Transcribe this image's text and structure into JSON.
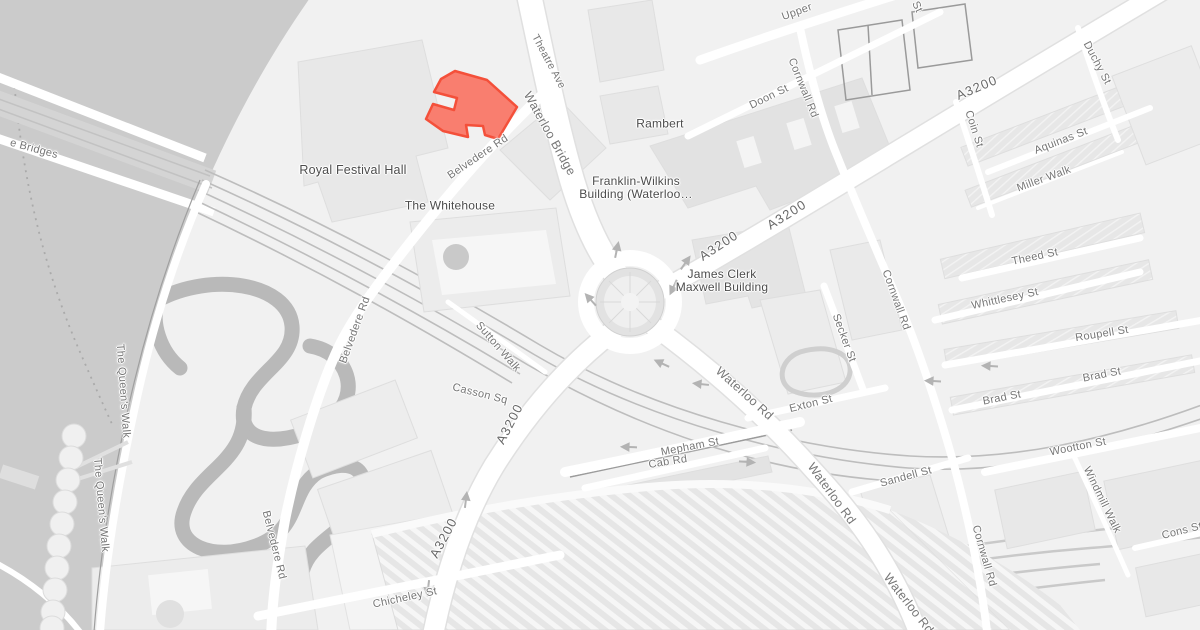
{
  "map": {
    "colors": {
      "land": "#f1f1f1",
      "water": "#cbcbcb",
      "road_fill": "#ffffff",
      "road_casing": "#e0e0e0",
      "building": "#e8e8e8",
      "building_stroke": "#dedede",
      "park_path": "#b9b9b9",
      "rail": "#bdbdbd",
      "highlight_fill": "#f97e6f",
      "highlight_stroke": "#f4503a",
      "poi_text": "#4c4c4c",
      "street_text": "#767676",
      "route_text": "#686868",
      "arrow": "#b3b3b3"
    },
    "poi_labels": [
      {
        "text": "Royal Festival Hall",
        "x": 353,
        "y": 171,
        "size": 12.5
      },
      {
        "text": "The Whitehouse",
        "x": 450,
        "y": 206
      },
      {
        "text": "Rambert",
        "x": 660,
        "y": 124
      },
      {
        "lines": [
          "Franklin-Wilkins",
          "Building (Waterloo…"
        ],
        "x": 636,
        "y": 188
      },
      {
        "lines": [
          "James Clerk",
          "Maxwell Building"
        ],
        "x": 722,
        "y": 281
      }
    ],
    "street_labels": [
      {
        "text": "Waterloo Bridge",
        "x": 549,
        "y": 134,
        "rotate": 61,
        "size": 12.5
      },
      {
        "text": "Belvedere Rd",
        "x": 478,
        "y": 157,
        "rotate": -34
      },
      {
        "text": "Belvedere Rd",
        "x": 355,
        "y": 330,
        "rotate": -70
      },
      {
        "text": "Belvedere Rd",
        "x": 274,
        "y": 545,
        "rotate": 76
      },
      {
        "text": "Theatre Ave",
        "x": 548,
        "y": 62,
        "rotate": 62,
        "size": 10.5
      },
      {
        "text": "Upper",
        "x": 797,
        "y": 12,
        "rotate": -20
      },
      {
        "text": "Doon St",
        "x": 769,
        "y": 97,
        "rotate": -26
      },
      {
        "text": "Cornwall Rd",
        "x": 803,
        "y": 88,
        "rotate": 68
      },
      {
        "text": "Cornwall Rd",
        "x": 896,
        "y": 300,
        "rotate": 70
      },
      {
        "text": "Cornwall Rd",
        "x": 984,
        "y": 556,
        "rotate": 74
      },
      {
        "text": "Coin St",
        "x": 974,
        "y": 129,
        "rotate": 72
      },
      {
        "text": "Duchy St",
        "x": 1097,
        "y": 63,
        "rotate": 62
      },
      {
        "text": "Aquinas St",
        "x": 1061,
        "y": 141,
        "rotate": -21
      },
      {
        "text": "Miller Walk",
        "x": 1044,
        "y": 179,
        "rotate": -20
      },
      {
        "text": "Theed St",
        "x": 1035,
        "y": 257,
        "rotate": -12
      },
      {
        "text": "Whittlesey St",
        "x": 1005,
        "y": 299,
        "rotate": -12
      },
      {
        "text": "Roupell St",
        "x": 1102,
        "y": 334,
        "rotate": -9
      },
      {
        "text": "Brad St",
        "x": 1002,
        "y": 398,
        "rotate": -11
      },
      {
        "text": "Brad St",
        "x": 1102,
        "y": 375,
        "rotate": -11
      },
      {
        "text": "Secker St",
        "x": 844,
        "y": 338,
        "rotate": 70
      },
      {
        "text": "Exton St",
        "x": 811,
        "y": 404,
        "rotate": -14
      },
      {
        "text": "Waterloo Rd",
        "x": 744,
        "y": 394,
        "rotate": 42,
        "size": 12.5
      },
      {
        "text": "Waterloo Rd",
        "x": 831,
        "y": 494,
        "rotate": 54,
        "size": 12.5
      },
      {
        "text": "Waterloo Rd",
        "x": 908,
        "y": 604,
        "rotate": 52,
        "size": 12.5
      },
      {
        "text": "Mepham St",
        "x": 690,
        "y": 447,
        "rotate": -11
      },
      {
        "text": "Cab Rd",
        "x": 668,
        "y": 462,
        "rotate": -9
      },
      {
        "text": "Sandell St",
        "x": 906,
        "y": 477,
        "rotate": -15
      },
      {
        "text": "Wootton St",
        "x": 1078,
        "y": 447,
        "rotate": -11
      },
      {
        "text": "Windmill Walk",
        "x": 1102,
        "y": 500,
        "rotate": 64
      },
      {
        "text": "Cons St",
        "x": 1182,
        "y": 531,
        "rotate": -14
      },
      {
        "text": "Sutton Walk",
        "x": 498,
        "y": 347,
        "rotate": 49
      },
      {
        "text": "Casson Sq",
        "x": 480,
        "y": 394,
        "rotate": 14
      },
      {
        "text": "Chicheley St",
        "x": 405,
        "y": 598,
        "rotate": -12
      },
      {
        "text": "The Queen's Walk",
        "x": 123,
        "y": 391,
        "rotate": 86
      },
      {
        "text": "The Queen's Walk",
        "x": 101,
        "y": 505,
        "rotate": 85
      },
      {
        "text": "e Bridges",
        "x": 34,
        "y": 149,
        "rotate": 15
      },
      {
        "text": "St",
        "x": 917,
        "y": 7,
        "rotate": 65
      }
    ],
    "route_labels": [
      {
        "text": "A3200",
        "x": 977,
        "y": 88,
        "rotate": -23
      },
      {
        "text": "A3200",
        "x": 787,
        "y": 215,
        "rotate": -32
      },
      {
        "text": "A3200",
        "x": 719,
        "y": 246,
        "rotate": -33
      },
      {
        "text": "A3200",
        "x": 510,
        "y": 424,
        "rotate": -63
      },
      {
        "text": "A3200",
        "x": 444,
        "y": 538,
        "rotate": -62
      }
    ]
  }
}
